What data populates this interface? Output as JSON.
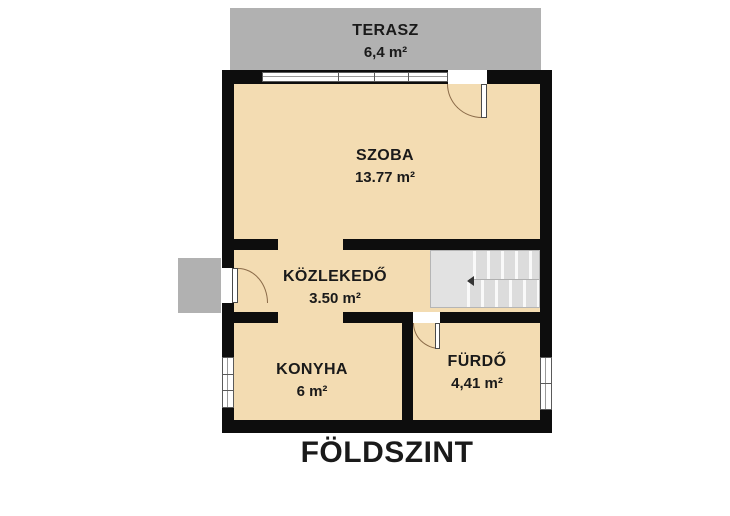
{
  "title": {
    "label": "FÖLDSZINT"
  },
  "rooms": [
    {
      "id": "terasz",
      "name": "TERASZ",
      "area": "6,4 m²"
    },
    {
      "id": "szoba",
      "name": "SZOBA",
      "area": "13.77 m²"
    },
    {
      "id": "kozlekedo",
      "name": "KÖZLEKEDŐ",
      "area": "3.50 m²"
    },
    {
      "id": "konyha",
      "name": "KONYHA",
      "area": "6 m²"
    },
    {
      "id": "furdo",
      "name": "FÜRDŐ",
      "area": "4,41 m²"
    }
  ],
  "colors": {
    "wall": "#0d0d0d",
    "floor_fill": "#f3dcb2",
    "terrace_fill": "#b1b1b1",
    "entry_step_fill": "#b1b1b1",
    "stairs_fill": "#e2e2e2",
    "window_fill": "#ffffff",
    "door_arc": "#8a6a48",
    "text": "#1a1a1a",
    "background": "#ffffff"
  },
  "elements": {
    "stairs": "staircase",
    "doors": [
      "terrace-door",
      "entrance-door",
      "bathroom-door"
    ],
    "windows": [
      "terrace-window-band",
      "kitchen-window",
      "bathroom-window"
    ]
  }
}
